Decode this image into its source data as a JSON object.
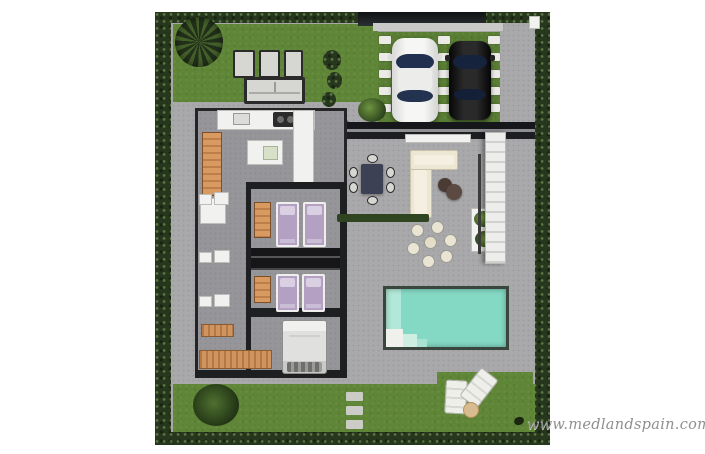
{
  "watermark": {
    "text": "www.medlandspain.com",
    "color": "#8f8f8d"
  },
  "palette": {
    "page_background": "#ffffff",
    "perimeter_hedge": "#26371d",
    "lawn_grass": "#5f8537",
    "terrace_concrete": "#a9a9ab",
    "interior_floor": "#96969a",
    "walls": "#1d1f20",
    "white_fixtures": "#f1f1ef",
    "wood_furniture": "#d2945e",
    "single_bed_lilac": "#b3a0c2",
    "double_bed_gray": "#e2e2e0",
    "pool_water": "#82d8c3",
    "pool_shallow": "#b2e8d9",
    "sofa_cream": "#ece6d3",
    "dining_table_dark": "#3c4254",
    "car_white": "#f2f2f2",
    "car_black": "#161616",
    "car_glass": "#20304e",
    "lounger_white": "#eeeeea",
    "side_table_tan": "#d9bb90"
  },
  "objects": {
    "cars": [
      {
        "name": "white-car",
        "color": "#f2f2f2"
      },
      {
        "name": "black-car",
        "color": "#161616"
      }
    ],
    "bedrooms_single_beds": 4,
    "double_beds": 1,
    "sun_loungers": 2,
    "pool": {
      "color": "#82d8c3"
    }
  }
}
